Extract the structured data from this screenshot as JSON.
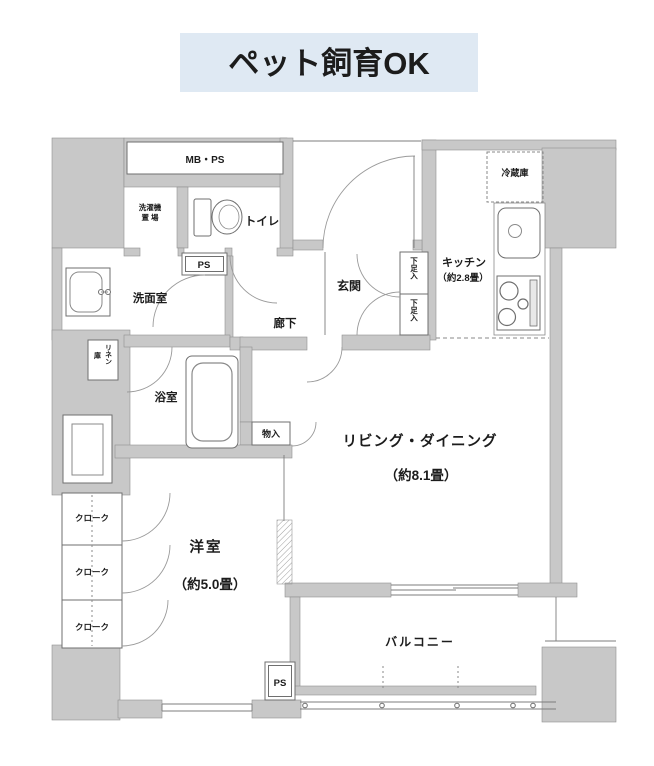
{
  "banner": {
    "text": "ペット飼育OK"
  },
  "colors": {
    "banner_bg": "#dfe9f3",
    "banner_text": "#111111",
    "wall_fill": "#c8c8c8",
    "line": "#7d7d7d",
    "label_text": "#1c1c1c"
  },
  "floorplan": {
    "labels": {
      "mbps": "MB・PS",
      "laundry_line1": "洗濯機",
      "laundry_line2": "置 場",
      "toilet": "トイレ",
      "ps_mid": "PS",
      "washroom": "洗面室",
      "hallway": "廊下",
      "entrance": "玄関",
      "shoe_upper": "下足入",
      "shoe_lower": "下足入",
      "kitchen": "キッチン",
      "kitchen_size": "（約2.8畳）",
      "fridge": "冷蔵庫",
      "linen_col1": "リネン",
      "linen_col2": "庫",
      "bath": "浴室",
      "storage": "物入",
      "living": "リビング・ダイニング",
      "living_size": "（約8.1畳）",
      "western": "洋室",
      "western_size": "（約5.0畳）",
      "cloak1": "クローク",
      "cloak2": "クローク",
      "cloak3": "クローク",
      "balcony": "バルコニー",
      "ps_bottom": "PS"
    }
  }
}
